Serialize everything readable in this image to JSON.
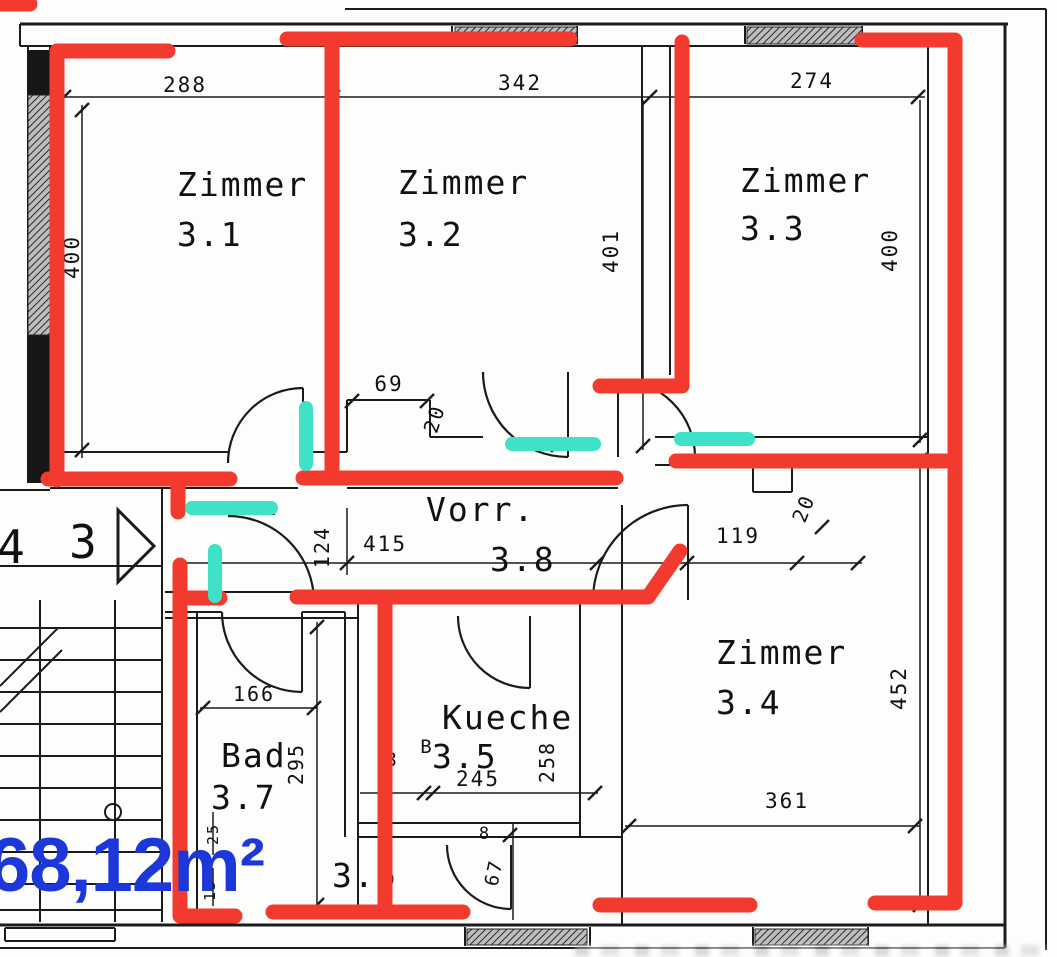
{
  "colors": {
    "red": "#f23a2e",
    "teal": "#3fe2c6",
    "blue": "#1c38d8",
    "ink": "#1b1b1b"
  },
  "area_label": {
    "text": "68,12m²"
  },
  "rooms": [
    {
      "id": "zimmer-3-1",
      "label": "Zimmer",
      "num": "3.1",
      "lx": 177,
      "ly": 196,
      "nx": 177,
      "ny": 246
    },
    {
      "id": "zimmer-3-2",
      "label": "Zimmer",
      "num": "3.2",
      "lx": 398,
      "ly": 194,
      "nx": 398,
      "ny": 246
    },
    {
      "id": "zimmer-3-3",
      "label": "Zimmer",
      "num": "3.3",
      "lx": 740,
      "ly": 192,
      "nx": 740,
      "ny": 240
    },
    {
      "id": "zimmer-3-4",
      "label": "Zimmer",
      "num": "3.4",
      "lx": 716,
      "ly": 664,
      "nx": 716,
      "ny": 714
    },
    {
      "id": "vorraum-3-8",
      "label": "Vorr.",
      "num": "3.8",
      "lx": 426,
      "ly": 521,
      "nx": 490,
      "ny": 571
    },
    {
      "id": "kueche-3-5",
      "label": "Kueche",
      "num": "3.5",
      "lx": 442,
      "ly": 729,
      "nx": 432,
      "ny": 768
    },
    {
      "id": "bad-3-7",
      "label": "Bad",
      "num": "3.7",
      "lx": 221,
      "ly": 767,
      "nx": 211,
      "ny": 809
    },
    {
      "id": "room-3-6",
      "label": "",
      "num": "3.6",
      "lx": 332,
      "ly": 887,
      "nx": 332,
      "ny": 887
    }
  ],
  "dims": [
    {
      "t": "288",
      "x": 185,
      "y": 92,
      "r": 0,
      "s": 21
    },
    {
      "t": "342",
      "x": 520,
      "y": 90,
      "r": 0,
      "s": 21
    },
    {
      "t": "274",
      "x": 812,
      "y": 88,
      "r": 0,
      "s": 21
    },
    {
      "t": "400",
      "x": 79,
      "y": 257,
      "r": -90,
      "s": 21
    },
    {
      "t": "401",
      "x": 618,
      "y": 251,
      "r": -90,
      "s": 21
    },
    {
      "t": "400",
      "x": 897,
      "y": 250,
      "r": -90,
      "s": 21
    },
    {
      "t": "69",
      "x": 389,
      "y": 391,
      "r": 0,
      "s": 21
    },
    {
      "t": "20",
      "x": 441,
      "y": 421,
      "r": -72,
      "s": 20
    },
    {
      "t": "124",
      "x": 329,
      "y": 547,
      "r": -90,
      "s": 20
    },
    {
      "t": "415",
      "x": 385,
      "y": 551,
      "r": 0,
      "s": 21
    },
    {
      "t": "119",
      "x": 738,
      "y": 543,
      "r": 0,
      "s": 21
    },
    {
      "t": "20",
      "x": 810,
      "y": 511,
      "r": -68,
      "s": 20
    },
    {
      "t": "452",
      "x": 906,
      "y": 688,
      "r": -90,
      "s": 21
    },
    {
      "t": "361",
      "x": 787,
      "y": 808,
      "r": 0,
      "s": 21
    },
    {
      "t": "295",
      "x": 303,
      "y": 764,
      "r": -90,
      "s": 20
    },
    {
      "t": "166",
      "x": 254,
      "y": 701,
      "r": 0,
      "s": 20
    },
    {
      "t": "245",
      "x": 478,
      "y": 786,
      "r": 0,
      "s": 21
    },
    {
      "t": "258",
      "x": 554,
      "y": 762,
      "r": -90,
      "s": 20
    },
    {
      "t": "B",
      "x": 427,
      "y": 753,
      "r": 0,
      "s": 19
    },
    {
      "t": "8",
      "x": 392,
      "y": 766,
      "r": 0,
      "s": 19
    },
    {
      "t": "8",
      "x": 485,
      "y": 839,
      "r": 0,
      "s": 17
    },
    {
      "t": "67",
      "x": 500,
      "y": 874,
      "r": -78,
      "s": 19
    },
    {
      "t": "25",
      "x": 218,
      "y": 834,
      "r": -90,
      "s": 15
    },
    {
      "t": "15",
      "x": 215,
      "y": 890,
      "r": -90,
      "s": 15
    },
    {
      "t": "4",
      "x": 12,
      "y": 563,
      "r": 0,
      "s": 46
    },
    {
      "t": "3",
      "x": 84,
      "y": 558,
      "r": 0,
      "s": 46
    }
  ],
  "geometry": {
    "lines": [
      [
        345,
        9,
        1046,
        9,
        2
      ],
      [
        1046,
        9,
        1046,
        950,
        2
      ],
      [
        20,
        24,
        1008,
        24,
        3
      ],
      [
        20,
        46,
        928,
        46,
        2
      ],
      [
        20,
        24,
        20,
        46,
        2
      ],
      [
        452,
        26,
        452,
        44,
        2
      ],
      [
        577,
        26,
        577,
        44,
        2
      ],
      [
        745,
        26,
        745,
        44,
        2
      ],
      [
        862,
        26,
        862,
        44,
        2
      ],
      [
        928,
        46,
        928,
        925,
        2
      ],
      [
        1005,
        24,
        1005,
        948,
        3
      ],
      [
        0,
        925,
        1005,
        925,
        3
      ],
      [
        0,
        948,
        1005,
        948,
        2
      ],
      [
        465,
        927,
        465,
        946,
        2
      ],
      [
        590,
        927,
        590,
        946,
        2
      ],
      [
        753,
        927,
        753,
        946,
        2
      ],
      [
        868,
        927,
        868,
        946,
        2
      ],
      [
        5,
        928,
        115,
        928,
        2
      ],
      [
        5,
        941,
        115,
        941,
        2
      ],
      [
        5,
        928,
        5,
        941,
        2
      ],
      [
        115,
        928,
        115,
        941,
        2
      ],
      [
        28,
        46,
        28,
        483,
        2
      ],
      [
        50,
        46,
        50,
        483,
        2
      ],
      [
        332,
        46,
        332,
        470,
        2
      ],
      [
        642,
        46,
        642,
        390,
        2
      ],
      [
        670,
        46,
        670,
        375,
        2
      ],
      [
        50,
        452,
        228,
        452,
        2
      ],
      [
        303,
        452,
        347,
        452,
        2
      ],
      [
        50,
        488,
        298,
        488,
        2
      ],
      [
        347,
        488,
        618,
        488,
        2
      ],
      [
        655,
        437,
        928,
        437,
        2
      ],
      [
        655,
        465,
        928,
        465,
        2
      ],
      [
        753,
        465,
        753,
        492,
        2
      ],
      [
        753,
        492,
        792,
        492,
        2
      ],
      [
        792,
        465,
        792,
        492,
        2
      ],
      [
        347,
        400,
        430,
        400,
        2
      ],
      [
        347,
        400,
        347,
        452,
        2
      ],
      [
        430,
        400,
        430,
        437,
        2
      ],
      [
        430,
        437,
        483,
        437,
        2
      ],
      [
        165,
        592,
        620,
        592,
        2
      ],
      [
        165,
        618,
        358,
        618,
        2
      ],
      [
        82,
        105,
        82,
        458,
        1.5
      ],
      [
        55,
        97,
        925,
        97,
        1.5
      ],
      [
        643,
        100,
        643,
        450,
        1.5
      ],
      [
        920,
        100,
        920,
        443,
        1.5
      ],
      [
        180,
        563,
        862,
        563,
        1.5
      ],
      [
        347,
        508,
        347,
        575,
        1.5
      ],
      [
        920,
        455,
        920,
        910,
        1.5
      ],
      [
        625,
        826,
        920,
        826,
        1.5
      ],
      [
        317,
        622,
        317,
        910,
        1.5
      ],
      [
        200,
        708,
        317,
        708,
        1.5
      ],
      [
        360,
        793,
        598,
        793,
        1.5
      ],
      [
        513,
        823,
        513,
        920,
        1.5
      ],
      [
        213,
        812,
        213,
        855,
        1.5
      ],
      [
        213,
        868,
        213,
        906,
        1.5
      ],
      [
        0,
        566,
        162,
        566,
        2
      ],
      [
        40,
        600,
        40,
        922,
        2
      ],
      [
        115,
        600,
        115,
        922,
        2
      ],
      [
        162,
        488,
        162,
        922,
        2
      ],
      [
        0,
        628,
        162,
        628,
        2
      ],
      [
        0,
        660,
        162,
        660,
        2
      ],
      [
        0,
        692,
        162,
        692,
        2
      ],
      [
        0,
        724,
        162,
        724,
        2
      ],
      [
        0,
        756,
        162,
        756,
        2
      ],
      [
        0,
        788,
        162,
        788,
        2
      ],
      [
        0,
        820,
        162,
        820,
        2
      ],
      [
        0,
        852,
        162,
        852,
        2
      ],
      [
        0,
        884,
        162,
        884,
        2
      ],
      [
        0,
        910,
        162,
        910,
        2
      ],
      [
        0,
        686,
        58,
        628,
        2
      ],
      [
        0,
        712,
        62,
        650,
        2
      ],
      [
        197,
        612,
        197,
        925,
        2
      ],
      [
        345,
        612,
        345,
        837,
        2
      ],
      [
        358,
        592,
        358,
        915,
        2
      ],
      [
        580,
        592,
        580,
        837,
        2
      ],
      [
        622,
        505,
        622,
        925,
        2
      ],
      [
        165,
        612,
        222,
        612,
        2
      ],
      [
        302,
        612,
        345,
        612,
        2
      ],
      [
        358,
        823,
        580,
        823,
        2
      ],
      [
        358,
        837,
        622,
        837,
        2
      ],
      [
        303,
        388,
        303,
        463,
        2
      ],
      [
        568,
        372,
        568,
        457,
        2
      ],
      [
        618,
        380,
        618,
        457,
        2
      ],
      [
        190,
        514,
        275,
        514,
        2
      ],
      [
        302,
        612,
        302,
        692,
        2
      ],
      [
        530,
        616,
        530,
        688,
        2
      ],
      [
        511,
        845,
        511,
        909,
        2
      ],
      [
        688,
        505,
        688,
        600,
        2
      ],
      [
        0,
        490,
        50,
        490,
        2
      ]
    ],
    "arcs": [
      "M 228 463 A 75 75 0 0 1 303 388",
      "M 483 372 A 85 85 0 0 0 568 457",
      "M 618 380 A 77 77 0 0 1 695 457",
      "M 228 516 A 86 86 0 0 1 314 602",
      "M 222 612 A 80 80 0 0 0 302 692",
      "M 458 616 A 72 72 0 0 0 530 688",
      "M 447 845 A 64 64 0 0 0 511 909",
      "M 688 505 A 95 95 0 0 0 593 600"
    ],
    "ticks": [
      [
        64,
        97
      ],
      [
        333,
        97
      ],
      [
        650,
        97
      ],
      [
        918,
        97
      ],
      [
        82,
        110
      ],
      [
        82,
        450
      ],
      [
        643,
        446
      ],
      [
        920,
        440
      ],
      [
        347,
        563
      ],
      [
        597,
        563
      ],
      [
        687,
        563
      ],
      [
        797,
        563
      ],
      [
        858,
        563
      ],
      [
        920,
        460
      ],
      [
        920,
        905
      ],
      [
        629,
        826
      ],
      [
        915,
        826
      ],
      [
        317,
        627
      ],
      [
        317,
        905
      ],
      [
        203,
        708
      ],
      [
        314,
        708
      ],
      [
        424,
        793
      ],
      [
        433,
        793
      ],
      [
        595,
        793
      ],
      [
        352,
        401
      ],
      [
        427,
        401
      ],
      [
        558,
        445
      ],
      [
        822,
        527
      ],
      [
        510,
        835
      ]
    ],
    "solid_rects": [
      [
        28,
        50,
        22,
        45
      ],
      [
        28,
        335,
        22,
        148
      ]
    ],
    "hatch_rects": [
      [
        28,
        95,
        22,
        240
      ],
      [
        455,
        27,
        122,
        17
      ],
      [
        747,
        27,
        115,
        17
      ],
      [
        467,
        929,
        120,
        16
      ],
      [
        755,
        929,
        113,
        16
      ]
    ],
    "circles": [
      [
        113,
        812,
        8
      ]
    ],
    "triangles": [
      "118,510 118,582 154,546"
    ],
    "red": [
      [
        [
          0,
          4
        ],
        [
          30,
          4
        ]
      ],
      [
        [
          168,
          51
        ],
        [
          57,
          51
        ],
        [
          57,
          480
        ]
      ],
      [
        [
          287,
          39
        ],
        [
          570,
          39
        ]
      ],
      [
        [
          332,
          43
        ],
        [
          332,
          473
        ]
      ],
      [
        [
          303,
          478
        ],
        [
          616,
          478
        ]
      ],
      [
        [
          48,
          479
        ],
        [
          230,
          479
        ]
      ],
      [
        [
          178,
          484
        ],
        [
          178,
          512
        ]
      ],
      [
        [
          682,
          42
        ],
        [
          682,
          386
        ],
        [
          600,
          386
        ]
      ],
      [
        [
          862,
          40
        ],
        [
          955,
          40
        ],
        [
          955,
          903
        ],
        [
          875,
          903
        ]
      ],
      [
        [
          676,
          461
        ],
        [
          946,
          461
        ]
      ],
      [
        [
          297,
          597
        ],
        [
          648,
          597
        ],
        [
          680,
          551
        ]
      ],
      [
        [
          385,
          600
        ],
        [
          385,
          911
        ]
      ],
      [
        [
          180,
          565
        ],
        [
          180,
          916
        ],
        [
          235,
          916
        ]
      ],
      [
        [
          180,
          598
        ],
        [
          220,
          598
        ]
      ],
      [
        [
          273,
          912
        ],
        [
          463,
          912
        ]
      ],
      [
        [
          600,
          905
        ],
        [
          750,
          905
        ]
      ]
    ],
    "teal": [
      [
        [
          306,
          408
        ],
        [
          306,
          464
        ]
      ],
      [
        [
          512,
          444
        ],
        [
          594,
          444
        ]
      ],
      [
        [
          681,
          439
        ],
        [
          748,
          439
        ]
      ],
      [
        [
          192,
          508
        ],
        [
          271,
          508
        ]
      ],
      [
        [
          215,
          551
        ],
        [
          215,
          596
        ]
      ]
    ]
  }
}
